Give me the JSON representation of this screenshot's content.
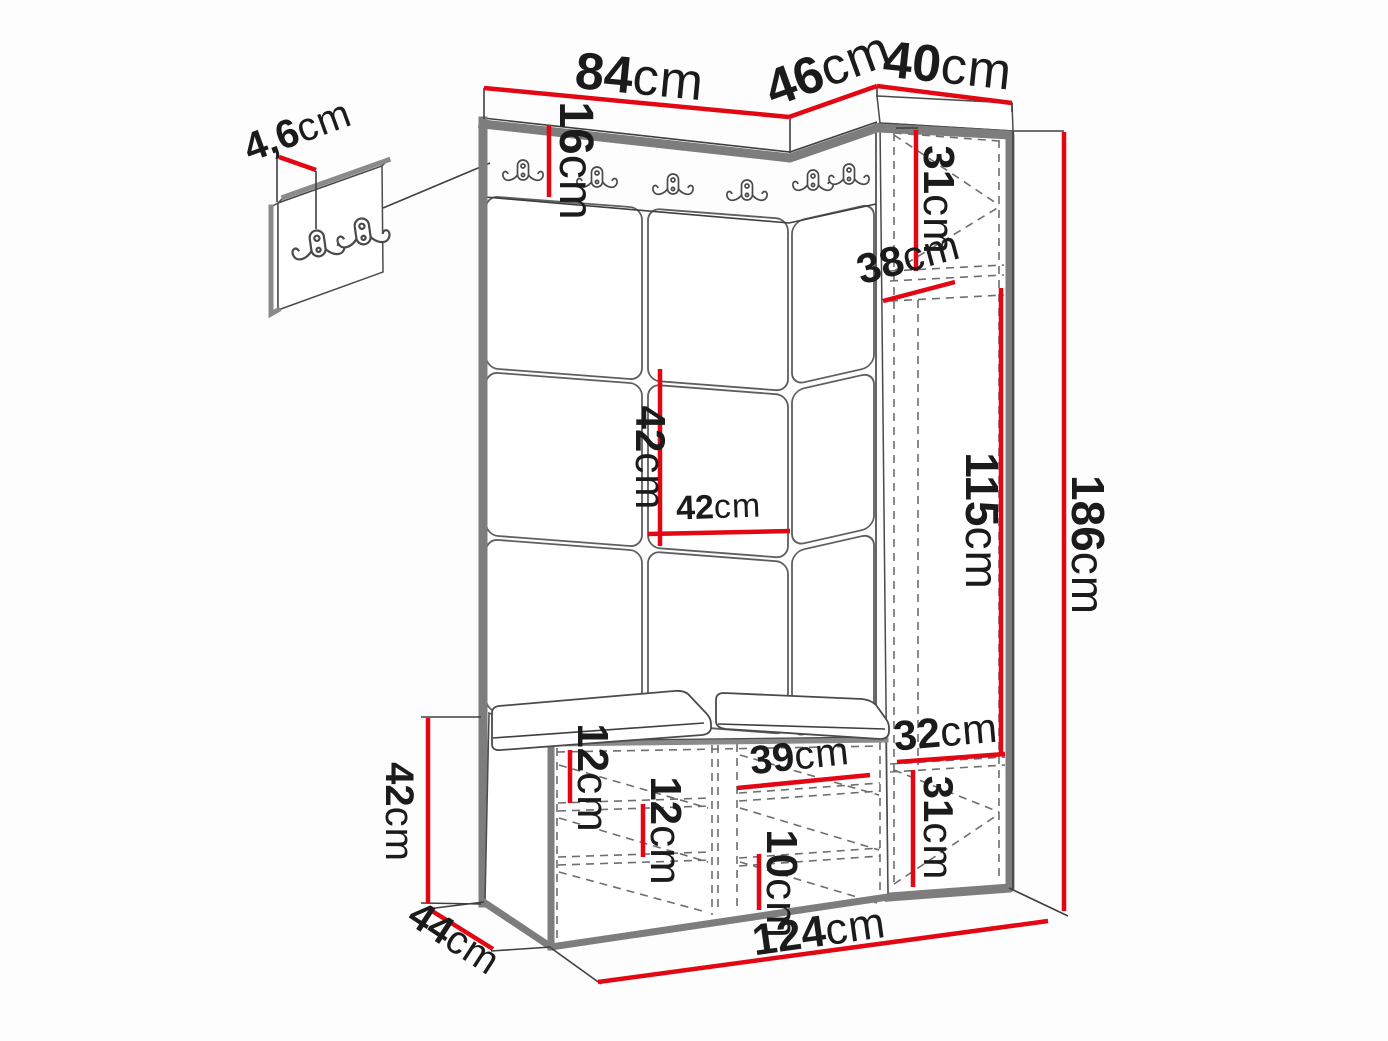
{
  "diagram": {
    "kind": "hallway furniture set dimension drawing",
    "unit": "cm",
    "colors": {
      "dimension_line": "#e30613",
      "outline": "#3f3f3f",
      "thick_edge": "#7d7d7d",
      "background": "#fdfdfd"
    }
  },
  "dims": {
    "top_left_width": {
      "v": "84",
      "u": "cm"
    },
    "top_mid_width": {
      "v": "46",
      "u": "cm"
    },
    "cabinet_width": {
      "v": "40",
      "u": "cm"
    },
    "hook_panel_depth": {
      "v": "4,6",
      "u": "cm"
    },
    "rail_height": {
      "v": "16",
      "u": "cm"
    },
    "cabinet_top_height": {
      "v": "31",
      "u": "cm"
    },
    "cabinet_depth": {
      "v": "38",
      "u": "cm"
    },
    "panel_height": {
      "v": "42",
      "u": "cm"
    },
    "panel_width": {
      "v": "42",
      "u": "cm"
    },
    "inner_height": {
      "v": "115",
      "u": "cm"
    },
    "total_height": {
      "v": "186",
      "u": "cm"
    },
    "bench_shelf_gap_top": {
      "v": "12",
      "u": "cm"
    },
    "bench_shelf_gap_mid": {
      "v": "12",
      "u": "cm"
    },
    "bench_compartment_width": {
      "v": "39",
      "u": "cm"
    },
    "bench_shelf_gap_low": {
      "v": "10",
      "u": "cm"
    },
    "cabinet_bottom_width": {
      "v": "32",
      "u": "cm"
    },
    "cabinet_bottom_height": {
      "v": "31",
      "u": "cm"
    },
    "bench_height": {
      "v": "42",
      "u": "cm"
    },
    "bench_depth": {
      "v": "44",
      "u": "cm"
    },
    "total_width": {
      "v": "124",
      "u": "cm"
    }
  }
}
